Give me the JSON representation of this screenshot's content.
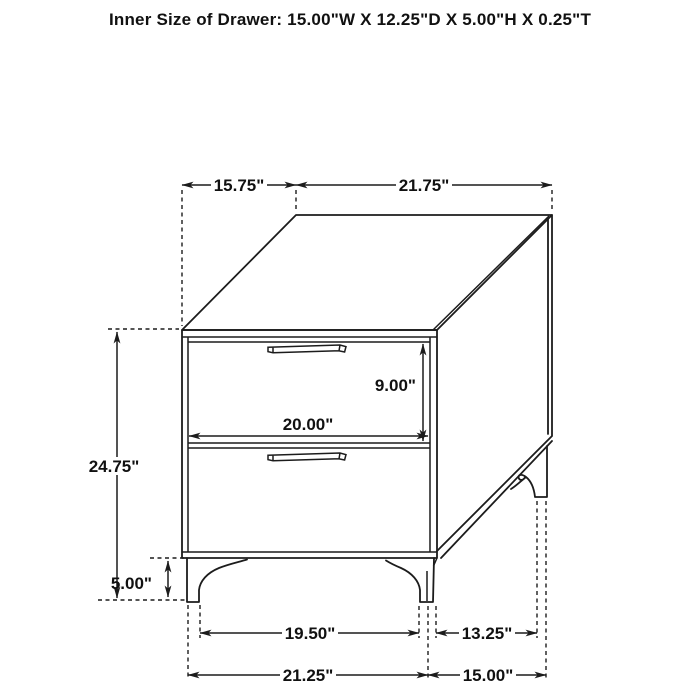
{
  "title": "Inner Size of Drawer: 15.00\"W X 12.25\"D X 5.00\"H X 0.25\"T",
  "drawing": {
    "subject": "two-drawer nightstand",
    "view": "isometric line drawing with dimension annotations",
    "drawer_count": 2
  },
  "dimensions": {
    "top_depth": "15.75\"",
    "top_width": "21.75\"",
    "overall_height": "24.75\"",
    "drawer_front_height": "9.00\"",
    "drawer_opening_width": "20.00\"",
    "leg_height": "5.00\"",
    "front_legs_inner_span": "19.50\"",
    "side_legs_inner_span": "13.25\"",
    "front_width_at_feet": "21.25\"",
    "side_depth_at_feet": "15.00\""
  },
  "colors": {
    "line": "#1c1c1c",
    "background": "#ffffff"
  }
}
